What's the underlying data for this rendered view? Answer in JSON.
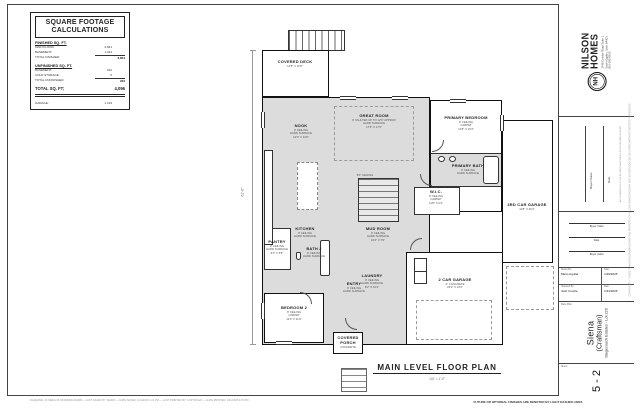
{
  "sqft": {
    "title_line1": "SQUARE FOOTAGE",
    "title_line2": "CALCULATIONS",
    "finished": {
      "header": "FINISHED SQ. FT.",
      "rows": [
        [
          "MAIN FLOOR:",
          "2,841"
        ],
        [
          "BASEMENT:",
          "1,013"
        ]
      ],
      "total_label": "TOTAL FINISHED:",
      "total": "3,854"
    },
    "unfinished": {
      "header": "UNFINISHED SQ. FT.",
      "rows": [
        [
          "BASEMENT:",
          "242"
        ],
        [
          "COLD STORAGE:",
          "0"
        ]
      ],
      "total_label": "TOTAL UNFINISHED:",
      "total": "242"
    },
    "grand": {
      "label": "TOTAL SQ. FT;",
      "value": "4,096"
    },
    "garage": {
      "label": "GARAGE:",
      "value": "1,193"
    }
  },
  "plan": {
    "title": "MAIN LEVEL FLOOR PLAN",
    "scale": "1/4\" = 1'-0\"",
    "dim_left": "61'-0\"",
    "rooms": {
      "deck": {
        "name": "COVERED DECK",
        "lines": [
          "12'8\" X 10'0\""
        ]
      },
      "nook": {
        "name": "NOOK",
        "lines": [
          "9' CEILING",
          "HARD SURFACE",
          "12'0\" X 13'0\""
        ]
      },
      "great": {
        "name": "GREAT ROOM",
        "lines": [
          "9' VAULTED UP TO 12'0\" APPROX",
          "HARD SURFACE",
          "17'8\" X 17'0\""
        ]
      },
      "kitchen": {
        "name": "KITCHEN",
        "lines": [
          "9' CEILING",
          "HARD SURFACE"
        ]
      },
      "pantry": {
        "name": "PANTRY",
        "lines": [
          "9' CEILING",
          "HARD SURFACE",
          "6'0\" X 6'8\""
        ]
      },
      "bath2": {
        "name": "BATH 2",
        "lines": [
          "9' CEILING",
          "HARD SURFACE"
        ]
      },
      "bedroom2": {
        "name": "BEDROOM 2",
        "lines": [
          "9' CEILING",
          "CARPET",
          "12'4\" X 11'0\""
        ]
      },
      "entry": {
        "name": "ENTRY",
        "lines": [
          "9' CEILING",
          "HARD SURFACE"
        ]
      },
      "porch": {
        "name": "COVERED PORCH",
        "lines": [
          "CONCRETE"
        ]
      },
      "laundry": {
        "name": "LAUNDRY",
        "lines": [
          "9' CEILING",
          "HARD SURFACE",
          "8'2\" X 10'4\""
        ]
      },
      "mud": {
        "name": "MUD ROOM",
        "lines": [
          "9' CEILING",
          "HARD SURFACE",
          "10'4\" X 7'0\""
        ]
      },
      "primary_bed": {
        "name": "PRIMARY BEDROOM",
        "lines": [
          "9' CEILING",
          "CARPET",
          "13'8\" X 15'4\""
        ]
      },
      "primary_bath": {
        "name": "PRIMARY BATH",
        "lines": [
          "9' CEILING",
          "HARD SURFACE"
        ]
      },
      "wic": {
        "name": "W.I.C.",
        "lines": [
          "9' CEILING",
          "CARPET",
          "11'8\" X 6'4\""
        ]
      },
      "garage3": {
        "name": "3RD CAR GARAGE",
        "lines": [
          "11'8\" X 26'4\""
        ]
      },
      "garage2": {
        "name": "2 CAR GARAGE",
        "lines": [
          "4\" CONCRETE",
          "23'0\" X 24'4\""
        ]
      }
    },
    "notes": {
      "drop": [
        "8'0\" CEILING",
        "AT DROP"
      ]
    }
  },
  "titleblock": {
    "brand_line1": "NILSON",
    "brand_line2": "HOMES",
    "logo_initials": "NH",
    "address": [
      "1748 Combe Road Suite 1",
      "South Ogden, Utah 84403",
      "801-392-8100"
    ],
    "buyer_notes_label": "Buyer Notes",
    "date_label": "Date",
    "notes_disclaimer": "ALL CHANGES MUST BE INITIALED AND DATED BY BUYER AND BUILDER",
    "initials": [
      "Buyer Initial",
      "Date",
      "Buyer Initial",
      "Date"
    ],
    "drawn_by_label": "Drawn By:",
    "drawn_by": "Mario Aguilar",
    "drawn_date_label": "Date:",
    "drawn_date": "1/29/2025",
    "checked_by_label": "Checked By:",
    "checked_by": "Josh Crowle",
    "checked_date_label": "Date:",
    "checked_date": "1/31/2025",
    "main_plan_label": "Main Plan:",
    "plan_name": "Siena",
    "plan_style": "(Craftsman)",
    "subdivision": "Stagecoach Estates - Lot 229",
    "sheet_label": "Sheet:",
    "sheet_number": "5 - 2",
    "copyright": "COPYRIGHT — THESE PLANS AND DRAWINGS ARE THE PROPERTY OF NILSON HOMES AND MAY NOT BE REPRODUCED OR COPIED WITHOUT WRITTEN PERMISSION"
  },
  "footer": {
    "file_info": "FILENAME: 30 SIENA 3S STANDING RAMB  —  LAST SAVED BY: MARIO  —  DATE SAVED: 1/31/2025 1:21 PM  —  LAST PRINTED BY: COPYRIGHT  —  DATE PRINTED: 1/31/2025 4:07 PM",
    "note": "FUTURE OR OPTIONAL FINISHES ARE DENOTED BY LIGHT DASHED LINES"
  }
}
